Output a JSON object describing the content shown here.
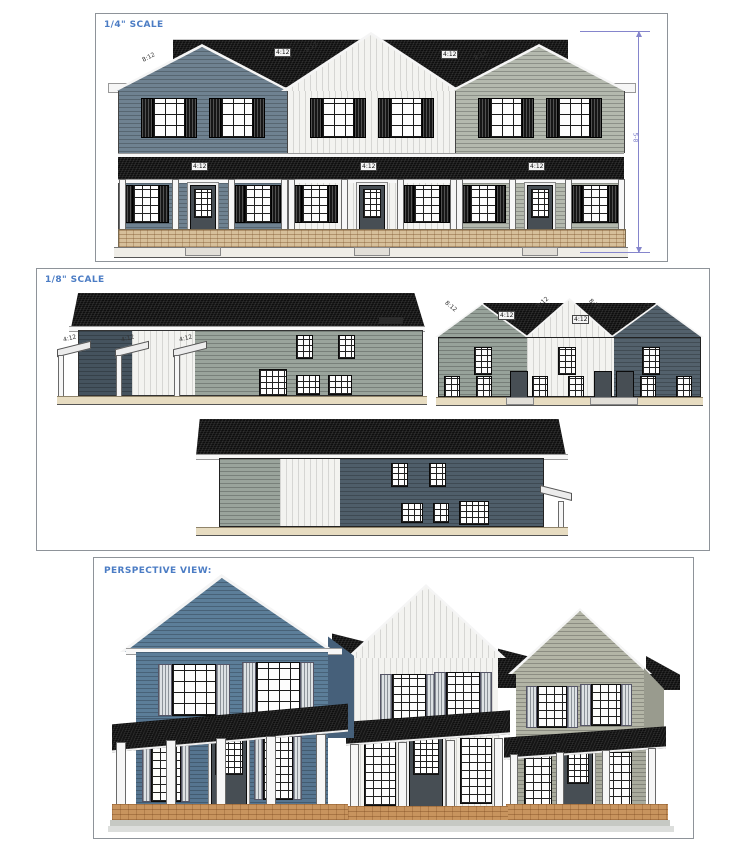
{
  "panels": {
    "front_elevation": {
      "scale_label": "1/4\" SCALE",
      "pitch": {
        "gable": "8:12",
        "main_roof": "4:12",
        "belt_roof": "4:12"
      },
      "height_dim": "5-8"
    },
    "eighth_scale": {
      "scale_label": "1/8\" SCALE",
      "pitch": {
        "gable": "8:12",
        "main_roof": "4:12",
        "porch_roof": "4:12"
      }
    },
    "perspective": {
      "title": "PERSPECTIVE VIEW:"
    }
  },
  "colors": {
    "label_blue": "#4b7cc4",
    "dimension_purple": "#8585cc",
    "roof_black": "#0e0e0e",
    "siding_slate_blue": "#6f8291",
    "siding_white": "#f3f3f0",
    "siding_gray_green": "#b4b9ae",
    "siding_dark_slate": "#4f5e6a",
    "rear_green": "#97a29a",
    "perspective_blue": "#5c7e99",
    "brick_tan": "#d6bf9a",
    "brick_perspective": "#c8945e"
  }
}
